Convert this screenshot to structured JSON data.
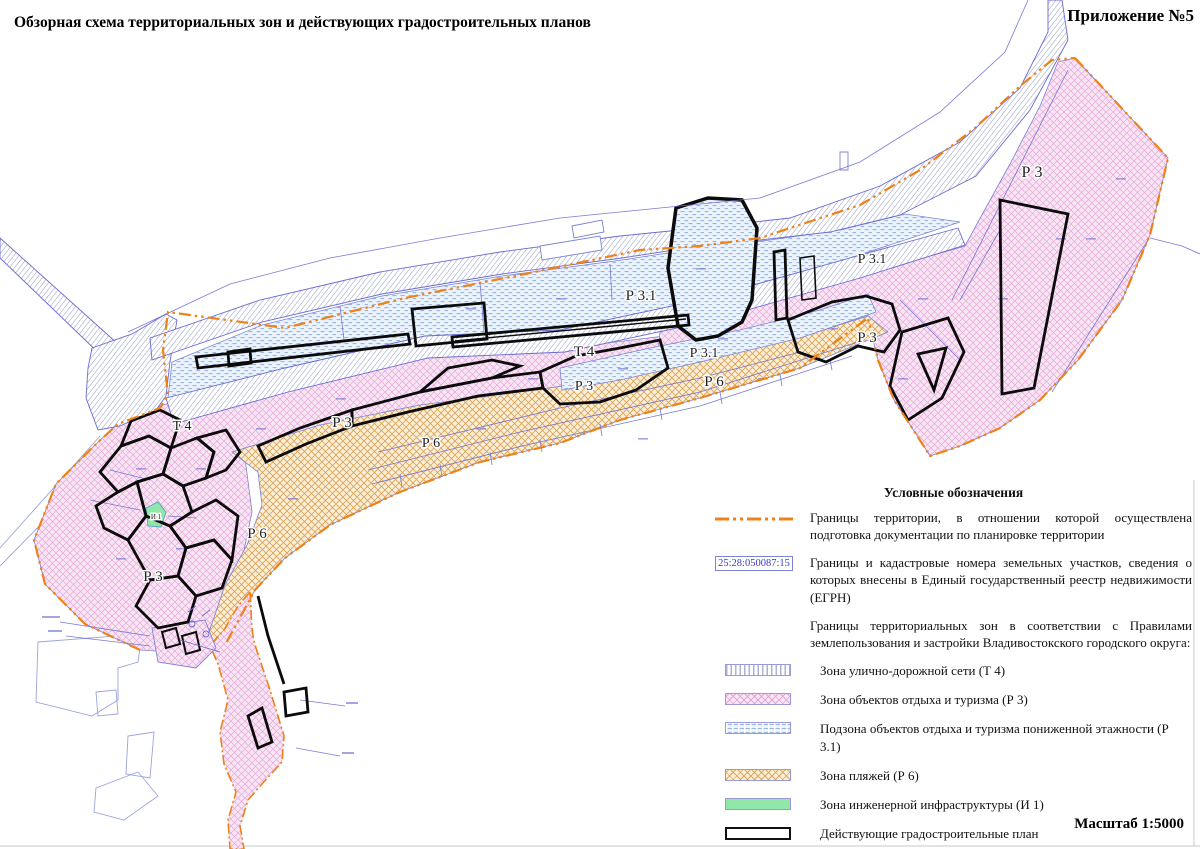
{
  "header": {
    "title": "Обзорная схема территориальных зон и действующих градостроительных планов",
    "appendix": "Приложение №5"
  },
  "legend": {
    "heading": "Условные обозначения",
    "items": [
      {
        "symbol": "territory-boundary-line",
        "text": "Границы территории, в отношении которой осуществлена подготовка документации по планировке территории"
      },
      {
        "symbol": "cadastral-parcel-box",
        "symbol_label": "25:28:050087:15",
        "text": "Границы и кадастровые номера земельных участков, сведения о которых внесены в Единый государственный реестр недвижимости (ЕГРН)"
      },
      {
        "symbol": "none",
        "text": "Границы территориальных зон в соответствии с Правилами землепользования и застройки Владивостокского городского округа:"
      }
    ],
    "zones": [
      {
        "swatch": "t4",
        "text": "Зона улично-дорожной сети (Т 4)"
      },
      {
        "swatch": "r3",
        "text": "Зона объектов отдыха и туризма (Р 3)"
      },
      {
        "swatch": "r31",
        "text": "Подзона объектов отдыха и туризма пониженной этажности (Р 3.1)"
      },
      {
        "swatch": "r6",
        "text": "Зона пляжей (Р 6)"
      },
      {
        "swatch": "i1",
        "text": "Зона инженерной инфраструктуры (И 1)"
      },
      {
        "swatch": "plan",
        "text": "Действующие градостроительные план"
      }
    ]
  },
  "map": {
    "cadastral_number_sample": "25:28:050087:15",
    "labels": [
      {
        "text": "Р 3",
        "x": 1032,
        "y": 177,
        "size": 16
      },
      {
        "text": "Р 3.1",
        "x": 872,
        "y": 263,
        "size": 14
      },
      {
        "text": "Р 3.1",
        "x": 641,
        "y": 300,
        "size": 15
      },
      {
        "text": "Т 4",
        "x": 584,
        "y": 356,
        "size": 15
      },
      {
        "text": "Р 3.1",
        "x": 704,
        "y": 357,
        "size": 14
      },
      {
        "text": "Р 3",
        "x": 867,
        "y": 342,
        "size": 15
      },
      {
        "text": "Р 6",
        "x": 714,
        "y": 386,
        "size": 15
      },
      {
        "text": "Р 3",
        "x": 584,
        "y": 390,
        "size": 14
      },
      {
        "text": "Р 3",
        "x": 342,
        "y": 427,
        "size": 15
      },
      {
        "text": "Р 6",
        "x": 431,
        "y": 447,
        "size": 14
      },
      {
        "text": "Т 4",
        "x": 182,
        "y": 430,
        "size": 14
      },
      {
        "text": "Р 6",
        "x": 257,
        "y": 538,
        "size": 15
      },
      {
        "text": "Р 3",
        "x": 153,
        "y": 581,
        "size": 15
      },
      {
        "text": "И 1",
        "x": 156,
        "y": 519,
        "size": 7
      }
    ]
  },
  "footer": {
    "scale": "Масштаб 1:5000"
  },
  "colors": {
    "territory_boundary": "#ef8119",
    "cadastral_blue": "#3a3ac8",
    "plan_outline": "#0b0b0b",
    "r3_fill": "#f9e6f4",
    "r31_fill": "#eaf3fb",
    "r6_fill": "#f9eed6",
    "i1_fill": "#90e8a8",
    "t4_hatch": "#99a2c4"
  }
}
